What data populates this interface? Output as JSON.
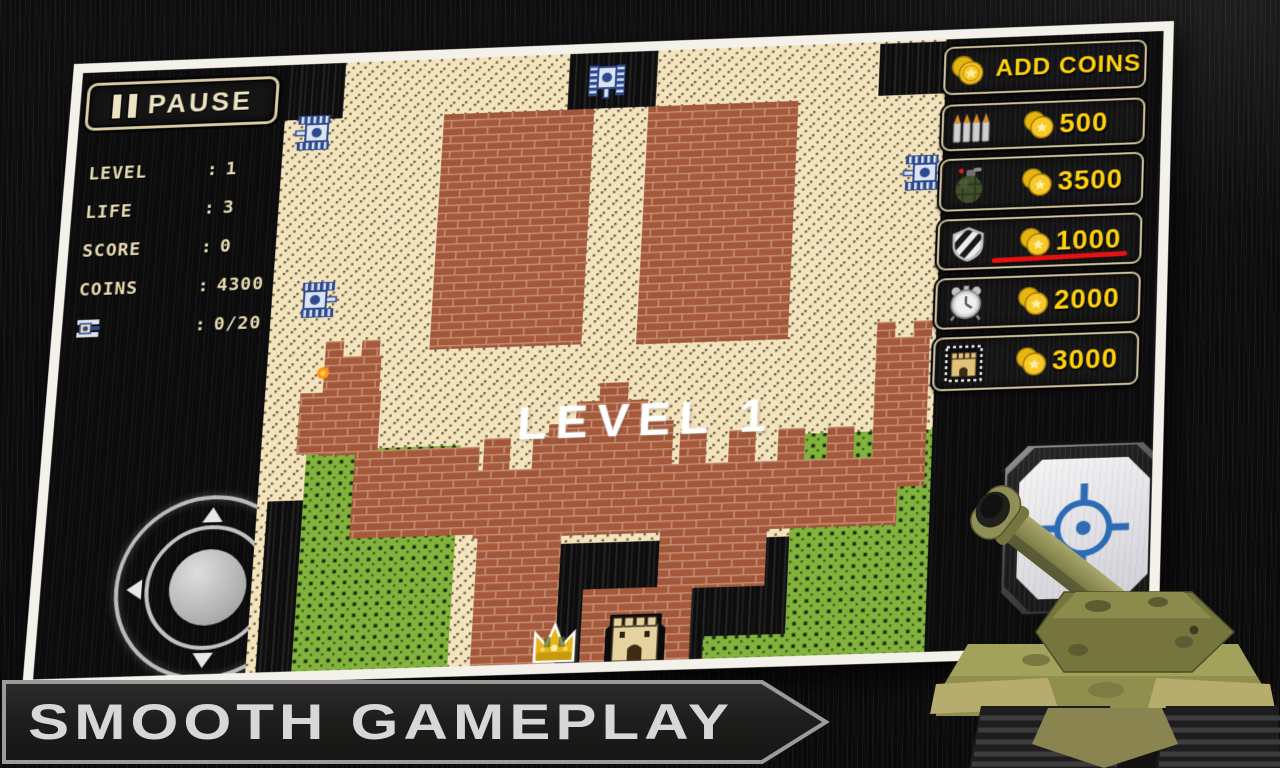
{
  "banner": {
    "label": "SMOOTH GAMEPLAY"
  },
  "game": {
    "pause_button": "PAUSE",
    "level_overlay": "LEVEL 1",
    "stats": {
      "separator": ":",
      "rows": [
        {
          "label": "LEVEL",
          "value": "1"
        },
        {
          "label": "LIFE",
          "value": "3"
        },
        {
          "label": "SCORE",
          "value": "0"
        },
        {
          "label": "COINS",
          "value": "4300"
        },
        {
          "label": "",
          "value": "0/20"
        }
      ]
    },
    "shop": {
      "header_label": "ADD COINS",
      "items": [
        {
          "id": "ammo",
          "price": "500"
        },
        {
          "id": "grenade",
          "price": "3500"
        },
        {
          "id": "shield",
          "price": "1000",
          "highlighted": true
        },
        {
          "id": "timer",
          "price": "2000"
        },
        {
          "id": "base",
          "price": "3000"
        }
      ]
    }
  },
  "colors": {
    "price_yellow": "#ffd20a",
    "hud_cream": "#e7dcb2",
    "underline_red": "#e31313",
    "field_cream": "#f4e4bc",
    "brick": "#9c4f33",
    "bush_green": "#7eae3a",
    "coin_gold": "#f7c928",
    "crosshair_blue": "#2d6cb4"
  }
}
